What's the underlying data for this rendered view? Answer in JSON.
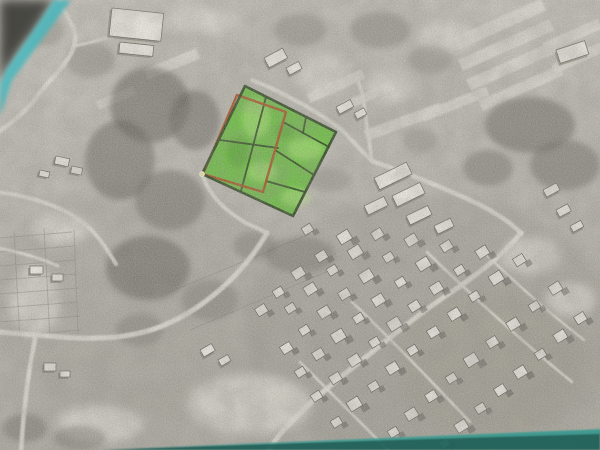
{
  "scene": {
    "kind": "photographed-aerial-parcel-map",
    "width": 600,
    "height": 450
  },
  "photo": {
    "base_top_color": "#c8c5bd",
    "base_mid_color": "#b9b6ae",
    "base_bottom_color": "#aaa79e",
    "light_color": "#dcd9d0",
    "dark_veg_color": "#55534c",
    "road_color": "#dedbd2",
    "plot_line_color": "#84817a",
    "grain_dark_opacity": 0.3,
    "grain_light_opacity": 0.25,
    "blotch_opacity": 0.25
  },
  "desk": {
    "teal_light": "#6fd8dc",
    "teal_mid": "#3f9ea4",
    "teal_dark": "#1f6059",
    "teal_bottom_hi": "#47a59b",
    "corner_shadow": "#43423e",
    "top_left_shadow_pts": "0,0 54,0 6,70 0,84",
    "top_left_teal_pts": "54,0 71,0 12,80 0,116 0,84 6,70",
    "bottom_strip_pts": "102,450 360,440 600,430 600,450",
    "bottom_strip_hi_pts": "140,448 600,429 600,434 200,446"
  },
  "parcel_overlay": {
    "fill_color": "#53c01e",
    "fill_opacity": 0.82,
    "light_cell_color": "#b9ef7f",
    "dark_cell_color": "#2f7d10",
    "outline_color": "#1f3a12",
    "outline_width": 2.6,
    "red_color": "#a84511",
    "red_width": 2.4,
    "inner_width": 1.8,
    "outer_polygon": [
      [
        245,
        86
      ],
      [
        336,
        132
      ],
      [
        293,
        216
      ],
      [
        202,
        174
      ]
    ],
    "red_polygon": [
      [
        237,
        95
      ],
      [
        286,
        112
      ],
      [
        263,
        192
      ],
      [
        203,
        174
      ]
    ],
    "inner_lines": [
      [
        [
          266,
          97
        ],
        [
          241,
          191
        ]
      ],
      [
        [
          220,
          140
        ],
        [
          278,
          148
        ]
      ],
      [
        [
          283,
          122
        ],
        [
          329,
          147
        ]
      ],
      [
        [
          306,
          117
        ],
        [
          303,
          133
        ]
      ],
      [
        [
          275,
          150
        ],
        [
          314,
          175
        ]
      ],
      [
        [
          266,
          181
        ],
        [
          305,
          192
        ]
      ]
    ],
    "light_accents": [
      {
        "x": 256,
        "y": 118,
        "rx": 14,
        "ry": 20
      },
      {
        "x": 305,
        "y": 149,
        "rx": 18,
        "ry": 11
      },
      {
        "x": 262,
        "y": 172,
        "rx": 15,
        "ry": 10
      },
      {
        "x": 296,
        "y": 197,
        "rx": 15,
        "ry": 9
      }
    ],
    "dark_accents": [
      {
        "x": 238,
        "y": 152,
        "rx": 11,
        "ry": 15
      },
      {
        "x": 284,
        "y": 131,
        "rx": 9,
        "ry": 7
      }
    ],
    "corner_marker": {
      "x": 202,
      "y": 174,
      "r": 2.6,
      "color": "#f3edad"
    }
  },
  "roads": [
    {
      "d": "M58,-2 C64,16 80,28 74,46 C68,66 46,82 36,98 C26,112 10,124 -2,132",
      "w": 4.5
    },
    {
      "d": "M74,46 C96,42 118,34 140,27",
      "w": 3
    },
    {
      "d": "M-2,192 C28,196 56,204 78,219 C96,231 106,248 116,264",
      "w": 4
    },
    {
      "d": "M-2,248 C20,252 40,258 58,266",
      "w": 3
    },
    {
      "d": "M203,176 C210,197 226,211 246,223 C256,228 262,230 267,233",
      "w": 4
    },
    {
      "d": "M267,233 C250,262 226,288 196,308 C172,324 152,331 130,335 C98,341 60,337 36,335 C24,334 10,333 -2,332",
      "w": 5
    },
    {
      "d": "M36,335 C30,362 24,402 21,452",
      "w": 4.5
    },
    {
      "d": "M252,80 C288,94 324,116 342,130 C355,143 362,152 372,161",
      "w": 4
    },
    {
      "d": "M372,161 C369,140 367,127 365,112 C364,100 361,88 357,77",
      "w": 3.5
    },
    {
      "d": "M372,161 C396,169 432,183 463,197 C491,209 509,221 521,233",
      "w": 4.5
    },
    {
      "d": "M521,233 C505,253 480,273 450,293 C414,317 380,346 346,373 C320,393 296,416 281,433 C275,441 271,446 268,452",
      "w": 5
    },
    {
      "d": "M352,302 C392,340 432,382 470,422",
      "w": 2.5
    },
    {
      "d": "M427,252 C470,294 525,344 572,382",
      "w": 2.5
    },
    {
      "d": "M300,362 C330,392 362,424 390,452",
      "w": 2.5
    },
    {
      "d": "M481,249 C512,280 548,312 584,340",
      "w": 2.2
    }
  ],
  "field_strips": [
    {
      "x": 500,
      "y": 24,
      "l": 95,
      "w": 13,
      "r": -24
    },
    {
      "x": 506,
      "y": 45,
      "l": 100,
      "w": 12,
      "r": -24
    },
    {
      "x": 512,
      "y": 66,
      "l": 95,
      "w": 12,
      "r": -24
    },
    {
      "x": 521,
      "y": 88,
      "l": 88,
      "w": 11,
      "r": -24
    },
    {
      "x": 572,
      "y": 36,
      "l": 60,
      "w": 11,
      "r": -24
    },
    {
      "x": 578,
      "y": 58,
      "l": 55,
      "w": 10,
      "r": -24
    },
    {
      "x": 403,
      "y": 122,
      "l": 80,
      "w": 11,
      "r": -20
    },
    {
      "x": 455,
      "y": 104,
      "l": 70,
      "w": 10,
      "r": -22
    },
    {
      "x": 172,
      "y": 64,
      "l": 56,
      "w": 11,
      "r": -22
    },
    {
      "x": 116,
      "y": 98,
      "l": 40,
      "w": 9,
      "r": -22
    },
    {
      "x": 336,
      "y": 86,
      "l": 60,
      "w": 10,
      "r": -24
    },
    {
      "x": 368,
      "y": 96,
      "l": 55,
      "w": 9,
      "r": -24
    }
  ],
  "light_patches": [
    {
      "x": 322,
      "y": 76,
      "rx": 26,
      "ry": 20
    },
    {
      "x": 390,
      "y": 86,
      "rx": 24,
      "ry": 18
    },
    {
      "x": 250,
      "y": 404,
      "rx": 62,
      "ry": 30
    },
    {
      "x": 100,
      "y": 424,
      "rx": 42,
      "ry": 18
    },
    {
      "x": 448,
      "y": 38,
      "rx": 30,
      "ry": 16
    },
    {
      "x": 200,
      "y": 20,
      "rx": 40,
      "ry": 14
    },
    {
      "x": 60,
      "y": 228,
      "rx": 30,
      "ry": 16
    },
    {
      "x": 34,
      "y": 300,
      "rx": 26,
      "ry": 34
    },
    {
      "x": 530,
      "y": 256,
      "rx": 30,
      "ry": 18
    },
    {
      "x": 570,
      "y": 300,
      "rx": 26,
      "ry": 16
    }
  ],
  "tints": [
    {
      "x": 430,
      "y": 330,
      "rx": 185,
      "ry": 135,
      "c": "#8b887f",
      "o": 0.25
    },
    {
      "x": 140,
      "y": 300,
      "rx": 150,
      "ry": 120,
      "c": "#979489",
      "o": 0.22
    },
    {
      "x": 300,
      "y": 60,
      "rx": 200,
      "ry": 70,
      "c": "#a29f96",
      "o": 0.2
    },
    {
      "x": 490,
      "y": 360,
      "rx": 95,
      "ry": 75,
      "c": "#8f8c72",
      "o": 0.16
    }
  ],
  "vegetation": [
    {
      "x": 150,
      "y": 105,
      "rx": 40,
      "ry": 38,
      "o": 0.55
    },
    {
      "x": 120,
      "y": 160,
      "rx": 35,
      "ry": 40,
      "o": 0.5
    },
    {
      "x": 170,
      "y": 200,
      "rx": 35,
      "ry": 30,
      "o": 0.45
    },
    {
      "x": 195,
      "y": 120,
      "rx": 25,
      "ry": 30,
      "o": 0.5
    },
    {
      "x": 148,
      "y": 268,
      "rx": 42,
      "ry": 32,
      "o": 0.55
    },
    {
      "x": 210,
      "y": 300,
      "rx": 28,
      "ry": 20,
      "o": 0.3
    },
    {
      "x": 530,
      "y": 125,
      "rx": 45,
      "ry": 28,
      "o": 0.5
    },
    {
      "x": 565,
      "y": 165,
      "rx": 35,
      "ry": 25,
      "o": 0.45
    },
    {
      "x": 488,
      "y": 168,
      "rx": 25,
      "ry": 18,
      "o": 0.4
    },
    {
      "x": 300,
      "y": 255,
      "rx": 35,
      "ry": 18,
      "o": 0.35
    },
    {
      "x": 255,
      "y": 246,
      "rx": 22,
      "ry": 14,
      "o": 0.3
    },
    {
      "x": 380,
      "y": 30,
      "rx": 30,
      "ry": 18,
      "o": 0.3
    },
    {
      "x": 300,
      "y": 30,
      "rx": 26,
      "ry": 16,
      "o": 0.28
    },
    {
      "x": 430,
      "y": 60,
      "rx": 22,
      "ry": 14,
      "o": 0.25
    },
    {
      "x": 25,
      "y": 428,
      "rx": 22,
      "ry": 14,
      "o": 0.4
    },
    {
      "x": 80,
      "y": 438,
      "rx": 26,
      "ry": 12,
      "o": 0.35
    },
    {
      "x": 140,
      "y": 330,
      "rx": 24,
      "ry": 16,
      "o": 0.3
    },
    {
      "x": 90,
      "y": 60,
      "rx": 24,
      "ry": 18,
      "o": 0.3
    },
    {
      "x": 45,
      "y": 30,
      "rx": 20,
      "ry": 16,
      "o": 0.28
    },
    {
      "x": 330,
      "y": 180,
      "rx": 20,
      "ry": 12,
      "o": 0.22
    },
    {
      "x": 420,
      "y": 140,
      "rx": 18,
      "ry": 12,
      "o": 0.22
    }
  ],
  "plot_lines": [
    "M0,238 L72,232",
    "M0,252 L74,246",
    "M0,266 L76,260",
    "M0,280 L76,274",
    "M0,294 L78,288",
    "M0,308 L78,302",
    "M0,322 L80,316",
    "M14,336 L80,330",
    "M14,230 L20,340",
    "M44,228 L50,338",
    "M74,230 L78,334",
    "M160,296 L310,234",
    "M190,330 L340,266"
  ],
  "buildings": [
    {
      "x": 112,
      "y": 8,
      "w": 52,
      "h": 28,
      "r": 6
    },
    {
      "x": 120,
      "y": 42,
      "w": 34,
      "h": 11,
      "r": 6
    },
    {
      "x": 264,
      "y": 58,
      "w": 21,
      "h": 11,
      "r": -28
    },
    {
      "x": 286,
      "y": 68,
      "w": 14,
      "h": 8,
      "r": -28
    },
    {
      "x": 556,
      "y": 50,
      "w": 30,
      "h": 14,
      "r": -18
    },
    {
      "x": 336,
      "y": 107,
      "w": 16,
      "h": 8,
      "r": -28
    },
    {
      "x": 354,
      "y": 113,
      "w": 11,
      "h": 7,
      "r": -28
    },
    {
      "x": 374,
      "y": 178,
      "w": 36,
      "h": 13,
      "r": -26
    },
    {
      "x": 392,
      "y": 196,
      "w": 31,
      "h": 12,
      "r": -26
    },
    {
      "x": 364,
      "y": 206,
      "w": 22,
      "h": 10,
      "r": -26
    },
    {
      "x": 406,
      "y": 216,
      "w": 24,
      "h": 10,
      "r": -26
    },
    {
      "x": 434,
      "y": 226,
      "w": 18,
      "h": 9,
      "r": -26
    },
    {
      "x": 543,
      "y": 190,
      "w": 15,
      "h": 8,
      "r": -28
    },
    {
      "x": 556,
      "y": 210,
      "w": 13,
      "h": 8,
      "r": -28
    },
    {
      "x": 570,
      "y": 226,
      "w": 12,
      "h": 7,
      "r": -28
    },
    {
      "x": 56,
      "y": 156,
      "w": 14,
      "h": 8,
      "r": 12
    },
    {
      "x": 72,
      "y": 166,
      "w": 11,
      "h": 7,
      "r": 12
    },
    {
      "x": 40,
      "y": 170,
      "w": 10,
      "h": 6,
      "r": 12
    },
    {
      "x": 30,
      "y": 266,
      "w": 13,
      "h": 8,
      "r": 0
    },
    {
      "x": 52,
      "y": 274,
      "w": 11,
      "h": 7,
      "r": 0
    },
    {
      "x": 44,
      "y": 363,
      "w": 12,
      "h": 8,
      "r": 0
    },
    {
      "x": 60,
      "y": 371,
      "w": 10,
      "h": 6,
      "r": 0
    },
    {
      "x": 200,
      "y": 350,
      "w": 13,
      "h": 8,
      "r": -30
    },
    {
      "x": 218,
      "y": 360,
      "w": 11,
      "h": 7,
      "r": -30
    }
  ],
  "houses": {
    "color": "#e9e6de",
    "edge_color": "#55534d",
    "shadow_color": "#4e4c46",
    "rotation": -32,
    "list": [
      [
        345,
        238,
        13
      ],
      [
        322,
        257,
        11
      ],
      [
        299,
        274,
        12
      ],
      [
        279,
        293,
        10
      ],
      [
        262,
        311,
        11
      ],
      [
        378,
        235,
        11
      ],
      [
        356,
        253,
        13
      ],
      [
        333,
        271,
        10
      ],
      [
        311,
        290,
        12
      ],
      [
        291,
        309,
        10
      ],
      [
        412,
        241,
        12
      ],
      [
        389,
        258,
        10
      ],
      [
        367,
        277,
        13
      ],
      [
        345,
        295,
        11
      ],
      [
        325,
        313,
        12
      ],
      [
        305,
        331,
        10
      ],
      [
        287,
        349,
        11
      ],
      [
        447,
        247,
        11
      ],
      [
        424,
        265,
        13
      ],
      [
        401,
        283,
        10
      ],
      [
        379,
        301,
        12
      ],
      [
        359,
        319,
        10
      ],
      [
        339,
        337,
        13
      ],
      [
        319,
        355,
        11
      ],
      [
        301,
        373,
        10
      ],
      [
        483,
        253,
        12
      ],
      [
        460,
        271,
        10
      ],
      [
        437,
        289,
        12
      ],
      [
        415,
        307,
        11
      ],
      [
        395,
        325,
        13
      ],
      [
        375,
        343,
        10
      ],
      [
        355,
        361,
        12
      ],
      [
        336,
        379,
        11
      ],
      [
        317,
        397,
        10
      ],
      [
        520,
        261,
        11
      ],
      [
        497,
        279,
        13
      ],
      [
        475,
        297,
        10
      ],
      [
        455,
        315,
        12
      ],
      [
        434,
        333,
        11
      ],
      [
        413,
        351,
        10
      ],
      [
        393,
        369,
        12
      ],
      [
        374,
        387,
        10
      ],
      [
        355,
        405,
        13
      ],
      [
        337,
        423,
        10
      ],
      [
        556,
        289,
        12
      ],
      [
        535,
        307,
        10
      ],
      [
        514,
        325,
        12
      ],
      [
        493,
        343,
        11
      ],
      [
        472,
        361,
        13
      ],
      [
        452,
        379,
        10
      ],
      [
        432,
        397,
        11
      ],
      [
        412,
        415,
        12
      ],
      [
        394,
        433,
        10
      ],
      [
        581,
        319,
        11
      ],
      [
        561,
        337,
        12
      ],
      [
        541,
        355,
        10
      ],
      [
        521,
        373,
        12
      ],
      [
        501,
        391,
        11
      ],
      [
        481,
        409,
        10
      ],
      [
        462,
        427,
        12
      ],
      [
        445,
        444,
        10
      ],
      [
        308,
        230,
        10
      ]
    ]
  }
}
